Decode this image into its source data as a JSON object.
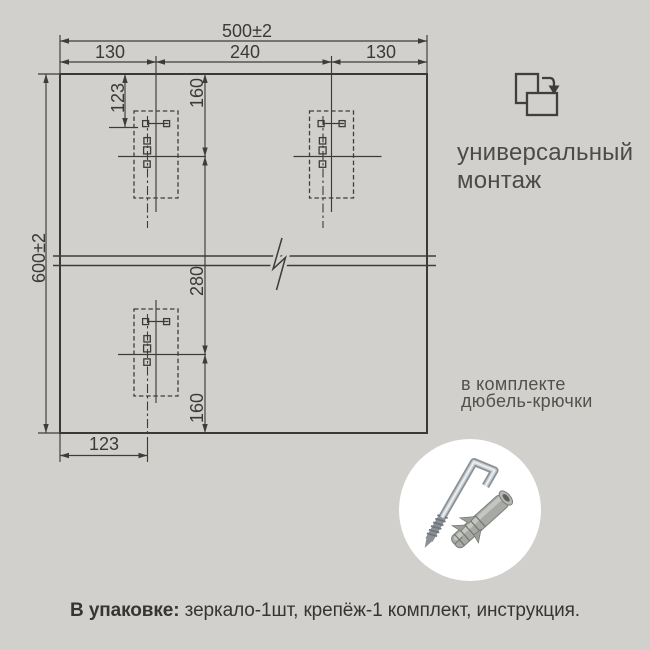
{
  "colors": {
    "background": "#d2d0cc",
    "line": "#3d3c39",
    "photo_circle": "#ffffff"
  },
  "drawing": {
    "total_width": "500±2",
    "total_height": "600±2",
    "chain": [
      "130",
      "240",
      "130"
    ],
    "offset_top": "123",
    "hook_top": "160",
    "span_mid": "280",
    "hook_bottom": "160",
    "offset_bottom": "123"
  },
  "side": {
    "universal_1": "универсальный",
    "universal_2": "монтаж",
    "kit_1": "в комплекте",
    "kit_2": "дюбель-крючки"
  },
  "icons": {
    "rotate_icon": "portrait-to-landscape-rotate",
    "hardware_photo": "hook-and-dowel"
  },
  "footer": {
    "label": "В упаковке:",
    "rest": " зеркало-1шт, крепёж-1 комплект, инструкция."
  }
}
